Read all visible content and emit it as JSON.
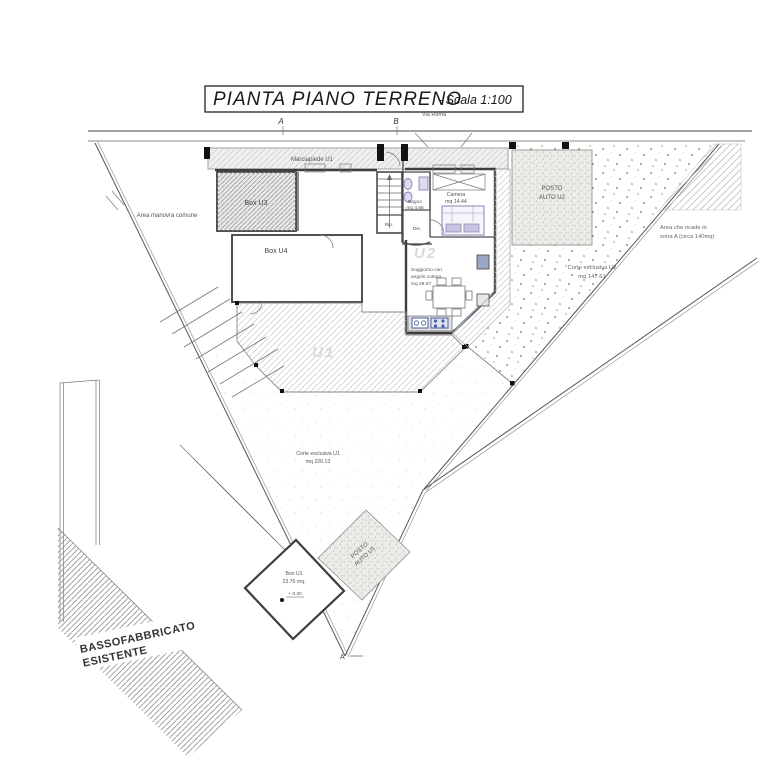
{
  "title": {
    "text": "PIANTA PIANO TERRENO",
    "scale": "- Scala 1:100"
  },
  "road": {
    "marker_a": "A",
    "marker_b": "B",
    "street": "Via Roma"
  },
  "labels": {
    "marciapiede": "Marciapiede U1",
    "area_manovra": "Area manovra comune",
    "zona_a": {
      "line1": "Area che ricade in",
      "line2": "zona A (circa 140mq)"
    },
    "corte_u2": {
      "line1": "Corte esclusiva U2",
      "line2": "mq 147.61"
    },
    "corte_u1": {
      "line1": "Corte esclusiva U1",
      "line2": "mq 220.13"
    },
    "posto_auto_u2": {
      "line1": "POSTO",
      "line2": "AUTO U2"
    },
    "posto_auto_u1": {
      "line1": "POSTO",
      "line2": "AUTO U1"
    },
    "bassofabbricato": {
      "line1": "BASSOFABBRICATO",
      "line2": "ESISTENTE"
    },
    "section_a": "A"
  },
  "rooms": {
    "box_u3": "Box U3",
    "box_u4": "Box U4",
    "box_u1": {
      "line1": "Box U1",
      "line2": "23.76 mq.",
      "level": "+ 0.30"
    },
    "camera": {
      "line1": "Camera",
      "line2": "mq 14.44"
    },
    "bagno": {
      "line1": "Bagno",
      "line2": "mq 4.66"
    },
    "dis": "Dis.",
    "rip": "Rip.",
    "soggiorno": {
      "line1": "Soggiorno con",
      "line2": "angolo cottura",
      "line3": "mq 29.97"
    },
    "watermark_u2": "U2",
    "watermark_u1": "U1"
  },
  "colors": {
    "wall": "#3d3d3d",
    "hatch_gray": "#bdbdbd",
    "green_speckle": "#84a35e",
    "fixture_purple": "#8c82b4",
    "kitchen_blue": "#4a5f9e",
    "paper": "#ffffff"
  }
}
